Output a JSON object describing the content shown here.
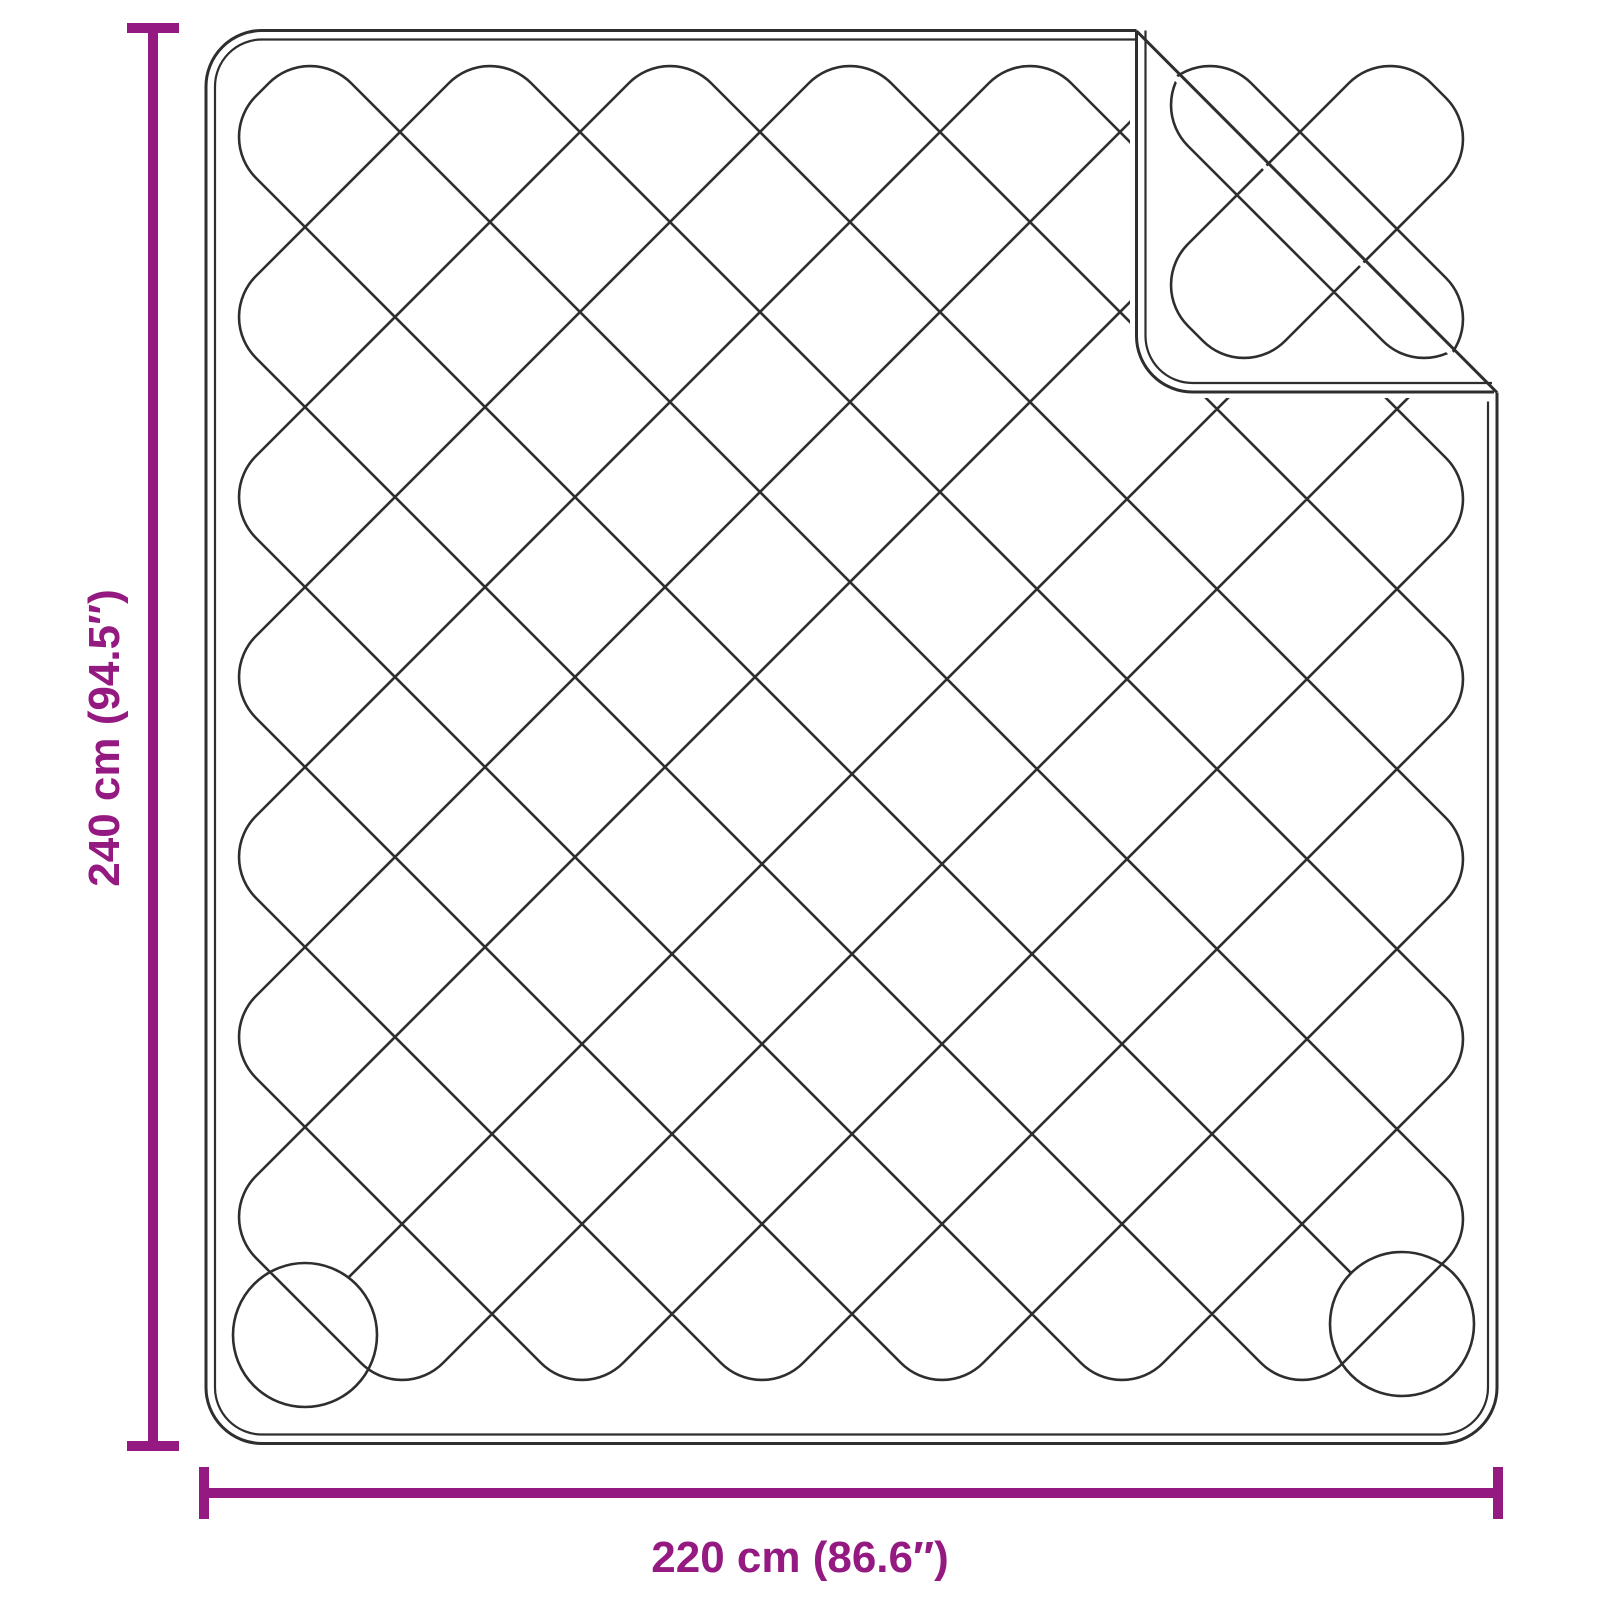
{
  "diagram": {
    "height_label": "240 cm (94.5″)",
    "width_label": "220 cm (86.6″)"
  },
  "colors": {
    "accent": "#941980",
    "line": "#2e2e2e",
    "background": "#ffffff"
  },
  "geometry": {
    "body": {
      "left": 206,
      "top": 30.5,
      "right": 1497,
      "bottom": 1443.5,
      "radius": 56,
      "inset": 9
    },
    "crease": [
      1136.5,
      31,
      1497,
      392.5
    ],
    "flap": {
      "left": 1136.5,
      "bottom": 392,
      "right": 1494
    },
    "reflect_c": 1105,
    "quilt": {
      "loop_radius": 58,
      "start": [
        1351.1,
        1273.1
      ],
      "start_circle": [
        1402,
        1324,
        72
      ],
      "end": [
        348.4,
        1277.6
      ],
      "end_circle": [
        305,
        1335,
        72
      ],
      "turns": [
        [
          215,
          137
        ],
        [
          310,
          42
        ],
        [
          1487,
          1219
        ],
        [
          1302,
          1404
        ],
        [
          215,
          317
        ],
        [
          490,
          42
        ],
        [
          1487,
          1039
        ],
        [
          1122,
          1404
        ],
        [
          215,
          497
        ],
        [
          670,
          42
        ],
        [
          1487,
          859
        ],
        [
          942,
          1404
        ],
        [
          215,
          677
        ],
        [
          850,
          42
        ],
        [
          1487,
          679
        ],
        [
          762,
          1404
        ],
        [
          215,
          857
        ],
        [
          1030,
          42
        ],
        [
          1487,
          499
        ],
        [
          582,
          1404
        ],
        [
          215,
          1037
        ],
        [
          1210,
          42
        ],
        [
          1487,
          319
        ],
        [
          402,
          1404
        ],
        [
          215,
          1217
        ],
        [
          1390,
          42
        ],
        [
          1487,
          139
        ]
      ]
    },
    "vdim": {
      "x": 153,
      "y1": 28,
      "y2": 1446,
      "tick_half": 26,
      "label_x": 119,
      "label_y": 738
    },
    "hdim": {
      "y": 1493,
      "x1": 204,
      "x2": 1498,
      "tick_half": 26,
      "label_x": 800,
      "label_y": 1572
    }
  }
}
